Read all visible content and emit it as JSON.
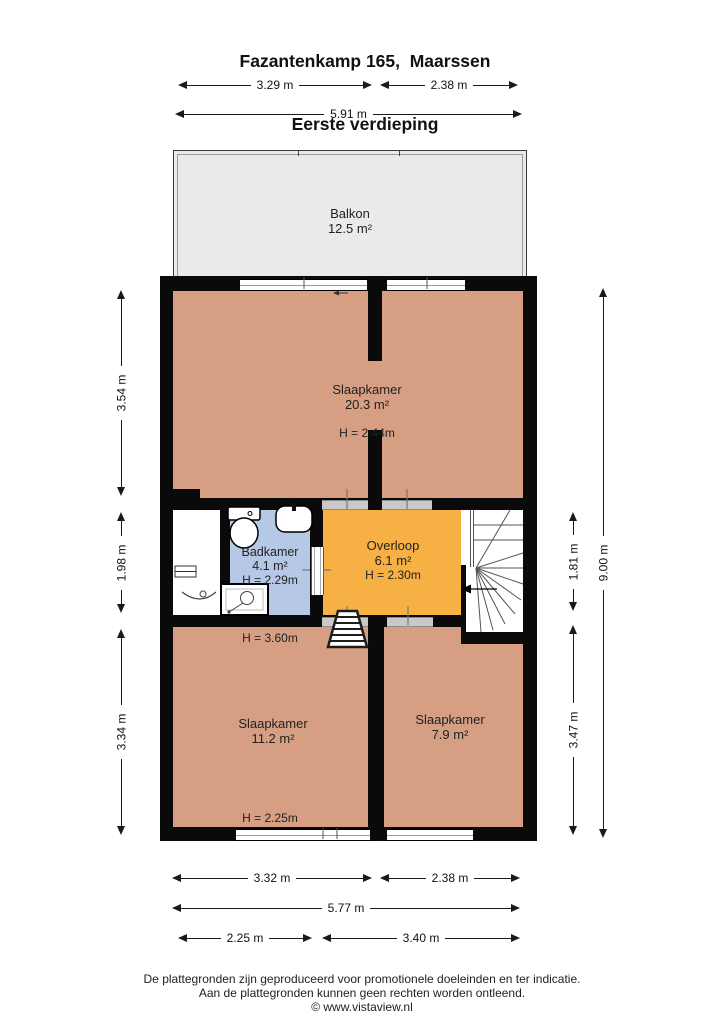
{
  "title": {
    "line1": "Fazantenkamp 165,  Maarssen",
    "line2": "Eerste verdieping"
  },
  "rooms": {
    "balkon": {
      "name": "Balkon",
      "area": "12.5 m²"
    },
    "slaapkamer_boven": {
      "name": "Slaapkamer",
      "area": "20.3 m²",
      "height": "H = 2.44m"
    },
    "badkamer": {
      "name": "Badkamer",
      "area": "4.1 m²",
      "height": "H = 2.29m"
    },
    "overloop": {
      "name": "Overloop",
      "area": "6.1 m²",
      "height": "H = 2.30m"
    },
    "slaapkamer_links": {
      "name": "Slaapkamer",
      "area": "11.2 m²",
      "height_top": "H = 3.60m",
      "height_bottom": "H = 2.25m"
    },
    "slaapkamer_rechts": {
      "name": "Slaapkamer",
      "area": "7.9 m²"
    }
  },
  "dimensions": {
    "top": [
      {
        "label": "3.29 m"
      },
      {
        "label": "2.38 m"
      },
      {
        "label": "5.91 m"
      }
    ],
    "left": [
      {
        "label": "3.54 m"
      },
      {
        "label": "1.98 m"
      },
      {
        "label": "3.34 m"
      }
    ],
    "right": [
      {
        "label": "1.81 m"
      },
      {
        "label": "3.47 m"
      },
      {
        "label": "9.00 m"
      }
    ],
    "bottom": [
      {
        "label": "3.32 m"
      },
      {
        "label": "2.38 m"
      },
      {
        "label": "5.77 m"
      },
      {
        "label": "2.25 m"
      },
      {
        "label": "3.40 m"
      }
    ]
  },
  "footer": {
    "line1": "De plattegronden zijn geproduceerd voor promotionele doeleinden en ter indicatie.",
    "line2": "Aan de plattegronden kunnen geen rechten worden ontleend.",
    "line3": "© www.vistaview.nl"
  },
  "icons": [
    "toilet-icon",
    "sink-icon",
    "shower-icon",
    "washbasin-icon",
    "radiator-icon",
    "winder-stairs-icon",
    "loft-ladder-icon",
    "stair-direction-arrow-icon",
    "balcony-door-arrow-icon"
  ],
  "colors": {
    "wall": "#0a0a0a",
    "bedroom_fill": "#d69e82",
    "hall_fill": "#f6b044",
    "bathroom_fill": "#b5c9e6",
    "balcony_fill": "#eaeaea",
    "door_opening": "#c9c9c9",
    "background": "#ffffff"
  }
}
